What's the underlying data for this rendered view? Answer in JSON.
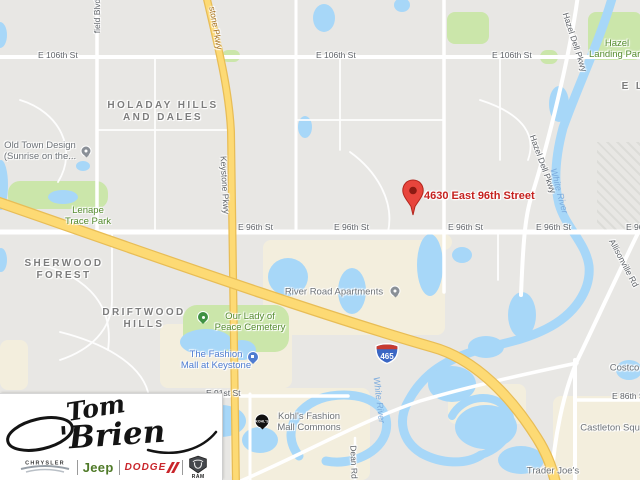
{
  "map": {
    "destination": {
      "address": "4630 East 96th Street"
    },
    "interstate_shield": "465",
    "labels": [
      {
        "name": "street-e106th-1",
        "kind": "street",
        "anchor": "left",
        "text": "E 106th St",
        "x": 38,
        "y": 50
      },
      {
        "name": "street-e106th-2",
        "kind": "street",
        "anchor": "left",
        "text": "E 106th St",
        "x": 316,
        "y": 50
      },
      {
        "name": "street-e106th-3",
        "kind": "street",
        "anchor": "left",
        "text": "E 106th St",
        "x": 492,
        "y": 50
      },
      {
        "name": "street-e96th-1",
        "kind": "street",
        "anchor": "left",
        "text": "E 96th St",
        "x": 238,
        "y": 222
      },
      {
        "name": "street-e96th-2",
        "kind": "street",
        "anchor": "left",
        "text": "E 96th St",
        "x": 334,
        "y": 222
      },
      {
        "name": "street-e96th-3",
        "kind": "street",
        "anchor": "left",
        "text": "E 96th St",
        "x": 448,
        "y": 222
      },
      {
        "name": "street-e96th-4",
        "kind": "street",
        "anchor": "left",
        "text": "E 96th St",
        "x": 536,
        "y": 222
      },
      {
        "name": "street-e96th-5",
        "kind": "street",
        "anchor": "left",
        "text": "E 96th St",
        "x": 626,
        "y": 222
      },
      {
        "name": "street-e91st",
        "kind": "street",
        "anchor": "left",
        "text": "E 91st St",
        "x": 206,
        "y": 388
      },
      {
        "name": "street-e86th",
        "kind": "street",
        "anchor": "left",
        "text": "E 86th St",
        "x": 612,
        "y": 391
      },
      {
        "name": "street-field-blvd",
        "kind": "street-v",
        "text": "field Blvd",
        "x": 97,
        "y": 16,
        "rot": -90
      },
      {
        "name": "street-keystone-pkwy-top",
        "kind": "hwy-v",
        "text": "stone Pkwy",
        "x": 216,
        "y": 28,
        "rot": 80
      },
      {
        "name": "street-keystone-pkwy",
        "kind": "street-v",
        "text": "Keystone Pkwy",
        "x": 225,
        "y": 185,
        "rot": 87
      },
      {
        "name": "street-hazel-dell-top",
        "kind": "street-v",
        "text": "Hazel Dell Pkwy",
        "x": 575,
        "y": 42,
        "rot": 72
      },
      {
        "name": "street-hazel-dell",
        "kind": "street-v",
        "text": "Hazel Dell Pkwy",
        "x": 543,
        "y": 164,
        "rot": 70
      },
      {
        "name": "street-allisonville-rd",
        "kind": "street-v",
        "text": "Allisonville Rd",
        "x": 624,
        "y": 263,
        "rot": 62
      },
      {
        "name": "street-dean-rd",
        "kind": "street-v",
        "text": "Dean Rd",
        "x": 354,
        "y": 462,
        "rot": 88
      },
      {
        "name": "water-white-river-1",
        "kind": "water",
        "text": "White River",
        "x": 559,
        "y": 191,
        "rot": 75
      },
      {
        "name": "water-white-river-2",
        "kind": "water",
        "text": "White River",
        "x": 379,
        "y": 400,
        "rot": 83
      },
      {
        "name": "hood-holaday-hills",
        "kind": "hood",
        "text": "HOLADAY HILLS\nAND DALES",
        "x": 163,
        "y": 112
      },
      {
        "name": "hood-sherwood-forest",
        "kind": "hood",
        "text": "SHERWOOD\nFOREST",
        "x": 64,
        "y": 270
      },
      {
        "name": "hood-driftwood-hills",
        "kind": "hood",
        "text": "DRIFTWOOD\nHILLS",
        "x": 144,
        "y": 319
      },
      {
        "name": "hood-el-fragment",
        "kind": "hood",
        "text": "E L",
        "x": 633,
        "y": 87
      },
      {
        "name": "park-lenape-trace",
        "kind": "park",
        "text": "Lenape\nTrace Park",
        "x": 88,
        "y": 216
      },
      {
        "name": "park-hazel-landing",
        "kind": "park",
        "text": "Hazel\nLanding Park",
        "x": 617,
        "y": 49
      },
      {
        "name": "park-our-lady-of-peace",
        "kind": "park",
        "text": "Our Lady of\nPeace Cemetery",
        "x": 250,
        "y": 322
      },
      {
        "name": "poi-old-town-design",
        "kind": "poi",
        "text": "Old Town Design\n(Sunrise on the...",
        "x": 40,
        "y": 151
      },
      {
        "name": "poi-river-road-apartments",
        "kind": "poi",
        "text": "River Road Apartments",
        "x": 334,
        "y": 292
      },
      {
        "name": "poi-kohls-fashion-mall-commons",
        "kind": "poi",
        "text": "Kohl's Fashion\nMall Commons",
        "x": 309,
        "y": 422
      },
      {
        "name": "poi-costco-wholesale",
        "kind": "poi",
        "text": "Costco Wholesale",
        "x": 648,
        "y": 368
      },
      {
        "name": "poi-castleton-square",
        "kind": "poi",
        "text": "Castleton Square",
        "x": 617,
        "y": 428
      },
      {
        "name": "poi-trader-joes",
        "kind": "poi",
        "text": "Trader Joe's",
        "x": 553,
        "y": 471
      },
      {
        "name": "shop-fashion-mall-keystone",
        "kind": "shop",
        "text": "The Fashion\nMall at Keystone",
        "x": 216,
        "y": 360
      },
      {
        "name": "destination-address-label",
        "kind": "dest",
        "anchor": "left",
        "text": "4630 East 96th Street",
        "x": 424,
        "y": 190
      }
    ],
    "pins": [
      {
        "name": "pin-old-town-design",
        "kind": "gray",
        "x": 86,
        "y": 151
      },
      {
        "name": "pin-river-road-apartments",
        "kind": "gray",
        "x": 395,
        "y": 291
      },
      {
        "name": "pin-fashion-mall",
        "kind": "shop",
        "x": 253,
        "y": 357
      },
      {
        "name": "pin-our-lady-of-peace",
        "kind": "parkpin",
        "x": 203,
        "y": 317
      },
      {
        "name": "pin-kohls",
        "kind": "kohls",
        "x": 262,
        "y": 421,
        "text": "KOHL'S"
      }
    ]
  },
  "logo": {
    "dealer_name": "Tom O'Brien",
    "script": {
      "tom": "Tom",
      "brien": "'Brien"
    },
    "brands": {
      "chrysler": "CHRYSLER",
      "jeep": "Jeep",
      "dodge": "DODGE",
      "ram": "RAM"
    }
  }
}
